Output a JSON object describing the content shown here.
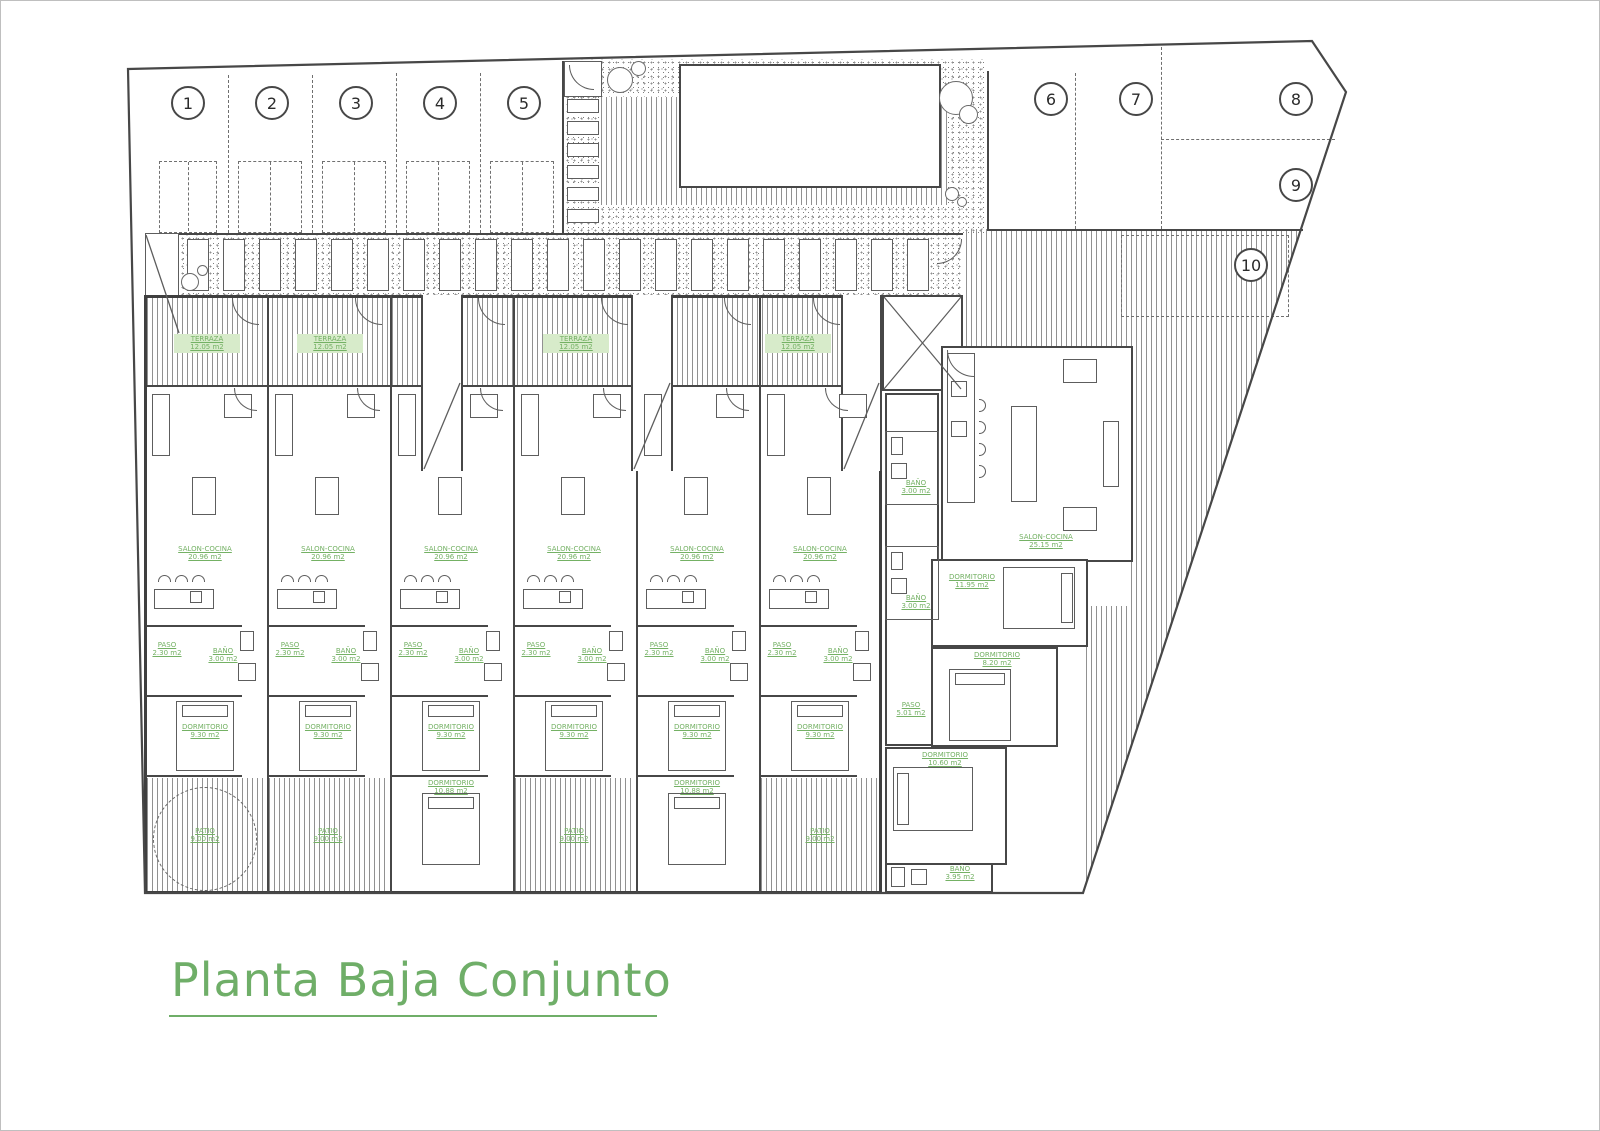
{
  "title": {
    "text": "Planta Baja Conjunto"
  },
  "parking": {
    "numbers": [
      "1",
      "2",
      "3",
      "4",
      "5",
      "6",
      "7",
      "8",
      "9",
      "10"
    ]
  },
  "labels": {
    "terraza": {
      "name": "TERRAZA",
      "area": "12.05 m2"
    },
    "salon": {
      "name": "SALON-COCINA",
      "area": "20.96 m2"
    },
    "salon_big": {
      "name": "SALON-COCINA",
      "area": "25.15 m2"
    },
    "bano": {
      "name": "BAÑO",
      "area": "3.00 m2"
    },
    "paso": {
      "name": "PASO",
      "area": "2.30 m2"
    },
    "dorm_mid": {
      "name": "DORMITORIO",
      "area": "9.30 m2"
    },
    "dorm_low": {
      "name": "DORMITORIO",
      "area": "10.88 m2"
    },
    "patio": {
      "name": "PATIO",
      "area": "9.00 m2"
    },
    "dorm_r1": {
      "name": "DORMITORIO",
      "area": "11.95 m2"
    },
    "dorm_r2": {
      "name": "DORMITORIO",
      "area": "8.20 m2"
    },
    "dorm_r3": {
      "name": "DORMITORIO",
      "area": "10.60 m2"
    },
    "bano_r": {
      "name": "BAÑO",
      "area": "3.95 m2"
    },
    "paso_r": {
      "name": "PASO",
      "area": "5.01 m2"
    }
  },
  "colors": {
    "green": "#6fae68",
    "label_green": "#74b164",
    "wall": "#474747"
  }
}
